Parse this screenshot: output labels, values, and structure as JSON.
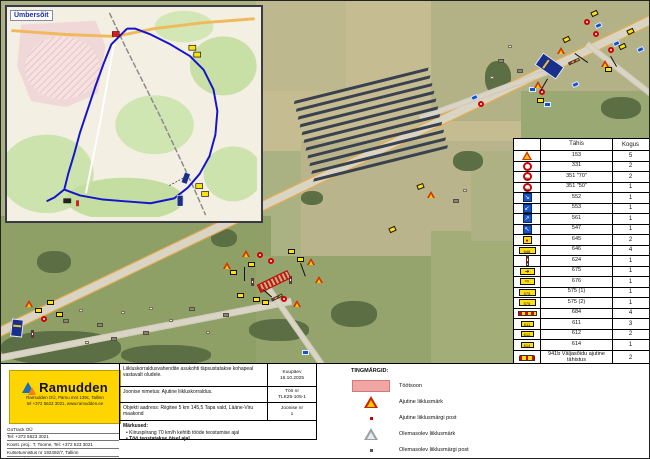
{
  "inset": {
    "label": "Ümbersõit",
    "route": "122,22 106,38 98,58 90,80 82,104 74,128 68,150 62,170 58,186 74,192 96,196 120,198 146,200 170,195 184,184 196,170 206,152 212,130 214,106 210,84 200,64 186,50 166,38 146,28 130,22 122,22",
    "route_spur": "58,186 48,194 40,198",
    "railway": "104,6 120,40 138,76 156,112 172,146 188,180 202,212",
    "main_road": "4,24 60,28 110,30 150,22 200,16 252,12",
    "side_road": "110,30 104,64 96,110 88,150 80,190"
  },
  "legend_table": {
    "headers": {
      "code": "Tähis",
      "count": "Kogus"
    },
    "rows": [
      {
        "icon": "sig-roadworks",
        "code": "153",
        "count": "5"
      },
      {
        "icon": "sig-noveh",
        "code": "331",
        "count": "2"
      },
      {
        "icon": "sig-speed",
        "glyph": "70",
        "code": "351 \"70\"",
        "count": "2"
      },
      {
        "icon": "sig-speed",
        "glyph": "50",
        "code": "351 \"50\"",
        "count": "1"
      },
      {
        "icon": "sig-blue",
        "glyph": "↘",
        "code": "552",
        "count": "1"
      },
      {
        "icon": "sig-blue",
        "glyph": "↙",
        "code": "553",
        "count": "1"
      },
      {
        "icon": "sig-blue",
        "glyph": "↗",
        "code": "561",
        "count": "1"
      },
      {
        "icon": "sig-blue",
        "glyph": "↖",
        "code": "547",
        "count": "1"
      },
      {
        "icon": "sig-ysmall",
        "glyph": "●",
        "code": "645",
        "count": "2"
      },
      {
        "icon": "sig-ywide",
        "glyph": "646",
        "code": "646",
        "count": "4"
      },
      {
        "icon": "sig-post",
        "code": "624",
        "count": "1"
      },
      {
        "icon": "sig-arrow",
        "glyph": "➔",
        "code": "675",
        "count": "1"
      },
      {
        "icon": "sig-arrow",
        "glyph": "⇨",
        "code": "676",
        "count": "1"
      },
      {
        "icon": "sig-ywide",
        "glyph": "575",
        "code": "575 (1)",
        "count": "1"
      },
      {
        "icon": "sig-ywide",
        "glyph": "575",
        "code": "575 (2)",
        "count": "1"
      },
      {
        "icon": "sig-barrier",
        "code": "684",
        "count": "4"
      },
      {
        "icon": "sig-tab",
        "glyph": "611",
        "code": "611",
        "count": "3"
      },
      {
        "icon": "sig-tab",
        "glyph": "612",
        "code": "612",
        "count": "2"
      },
      {
        "icon": "sig-tab",
        "glyph": "614",
        "code": "614",
        "count": "1"
      },
      {
        "icon": "sig-941",
        "code": "941b Väljasõidu ajutine tähistus",
        "count": "2",
        "tall": true
      },
      {
        "icon": "sig-flag-red",
        "code": "Post 1,8m",
        "count": "27"
      },
      {
        "icon": "sig-flag-magenta",
        "code": "Post 2,2m",
        "count": "3"
      },
      {
        "icon": "sig-flag-blue",
        "code": "Post 2,6m",
        "count": "2"
      },
      {
        "icon": "sig-lamp",
        "code": "Punane lamp",
        "count": "5"
      }
    ]
  },
  "tingmargid": {
    "title": "TINGMÄRGID:",
    "items": [
      {
        "icon": "tm-swatch",
        "name": "work-zone-swatch",
        "label": "Töötsoon"
      },
      {
        "icon": "tm-tri-temp",
        "name": "temporary-sign-icon",
        "label": "Ajutine liiklusmärk"
      },
      {
        "icon": "tm-dot-red",
        "name": "temporary-post-icon",
        "label": "Ajutine liiklusmärgi post"
      },
      {
        "icon": "tm-tri-ex",
        "name": "existing-sign-icon",
        "label": "Olemasolev liiklusmärk"
      },
      {
        "icon": "tm-dot-gray",
        "name": "existing-post-icon",
        "label": "Olemasolev liiklusmärgi post"
      }
    ]
  },
  "title_block": {
    "row1": {
      "text": "Liikluskorraldusvahendite asukohti täpsustatakse kohapeal vastavalt oludele.",
      "label": "Kuupäev",
      "value": "16.10.2025"
    },
    "row2": {
      "text": "Joonise nimetus: Ajutine liikluskorraldus.",
      "label": "Töö nr",
      "value": "TLK25-105-1"
    },
    "row3": {
      "text": "Objekti aadress: Riigitee 5 km 145,5 Tapa vald, Lääne-Viru maakond",
      "label": "Joonise nr",
      "value": "1"
    },
    "notes": {
      "title": "Märkused:",
      "items": [
        {
          "text": "Kiiruspiirang 70 km/h kehtib tööde teostamise ajal",
          "bold": false
        },
        {
          "text": "Töö teostatakse öisel ajal",
          "bold": true
        }
      ]
    }
  },
  "ramudden": {
    "name": "Ramudden",
    "sub": [
      "Ramudden OÜ, Pärnu mnt 139c, Tallinn",
      "tel +372 5623 3021, www.ramudden.ee"
    ]
  },
  "contact": {
    "lines": [
      "GoTrack OÜ",
      "Tel: +372 5623 3021",
      "Koost. proj.: T. Toome, Tel: +372 523 3021",
      "Kutsetunnistus nr 192492/7, Tallinn",
      "Tegevusluba nr ELK00025"
    ]
  },
  "map": {
    "markers": [
      {
        "x": 594,
        "y": 22,
        "t": "bs",
        "r": -25
      },
      {
        "x": 612,
        "y": 40,
        "t": "bs",
        "r": -25
      },
      {
        "x": 636,
        "y": 46,
        "t": "bs",
        "r": -25
      },
      {
        "x": 571,
        "y": 81,
        "t": "bs",
        "r": -25
      },
      {
        "x": 528,
        "y": 86,
        "t": "bs"
      },
      {
        "x": 543,
        "y": 101,
        "t": "bs"
      },
      {
        "x": 562,
        "y": 36,
        "t": "ys",
        "r": -25
      },
      {
        "x": 590,
        "y": 10,
        "t": "ys",
        "r": -25
      },
      {
        "x": 618,
        "y": 43,
        "t": "ys",
        "r": -25
      },
      {
        "x": 604,
        "y": 66,
        "t": "ys"
      },
      {
        "x": 536,
        "y": 97,
        "t": "ys"
      },
      {
        "x": 626,
        "y": 28,
        "t": "ys",
        "r": -25
      },
      {
        "x": 592,
        "y": 30,
        "t": "rc"
      },
      {
        "x": 607,
        "y": 46,
        "t": "rc"
      },
      {
        "x": 538,
        "y": 88,
        "t": "rc"
      },
      {
        "x": 583,
        "y": 18,
        "t": "rc"
      },
      {
        "x": 556,
        "y": 46,
        "t": "tr"
      },
      {
        "x": 600,
        "y": 59,
        "t": "tr"
      },
      {
        "x": 533,
        "y": 80,
        "t": "tr"
      },
      {
        "x": 567,
        "y": 59,
        "t": "br",
        "r": -25
      },
      {
        "x": 552,
        "y": 69,
        "t": "pp"
      },
      {
        "x": 541,
        "y": 52,
        "t": "board",
        "r": -55,
        "w": 15,
        "h": 26
      },
      {
        "x": 574,
        "y": 52,
        "t": "ln",
        "r": 35,
        "w": 16
      },
      {
        "x": 547,
        "y": 78,
        "t": "ln",
        "r": 120,
        "w": 14
      },
      {
        "x": 610,
        "y": 55,
        "t": "ln",
        "r": 60,
        "w": 12
      },
      {
        "x": 236,
        "y": 292,
        "t": "ys"
      },
      {
        "x": 247,
        "y": 261,
        "t": "ys"
      },
      {
        "x": 252,
        "y": 296,
        "t": "ys"
      },
      {
        "x": 287,
        "y": 248,
        "t": "ys"
      },
      {
        "x": 296,
        "y": 256,
        "t": "ys"
      },
      {
        "x": 261,
        "y": 299,
        "t": "ys"
      },
      {
        "x": 229,
        "y": 269,
        "t": "ys"
      },
      {
        "x": 222,
        "y": 261,
        "t": "tr"
      },
      {
        "x": 241,
        "y": 249,
        "t": "tr"
      },
      {
        "x": 306,
        "y": 257,
        "t": "tr"
      },
      {
        "x": 314,
        "y": 275,
        "t": "tr"
      },
      {
        "x": 292,
        "y": 299,
        "t": "tr"
      },
      {
        "x": 256,
        "y": 251,
        "t": "rc"
      },
      {
        "x": 280,
        "y": 295,
        "t": "rc"
      },
      {
        "x": 267,
        "y": 257,
        "t": "rc"
      },
      {
        "x": 250,
        "y": 277,
        "t": "pp"
      },
      {
        "x": 288,
        "y": 275,
        "t": "pp"
      },
      {
        "x": 270,
        "y": 295,
        "t": "br",
        "r": -26
      },
      {
        "x": 256,
        "y": 276,
        "t": "hatch",
        "r": -26,
        "w": 34,
        "h": 9
      },
      {
        "x": 244,
        "y": 266,
        "t": "ln",
        "r": 90,
        "w": 14
      },
      {
        "x": 300,
        "y": 262,
        "t": "ln",
        "r": 70,
        "w": 14
      },
      {
        "x": 262,
        "y": 288,
        "t": "ln",
        "r": 40,
        "w": 12
      },
      {
        "x": 34,
        "y": 307,
        "t": "ys"
      },
      {
        "x": 46,
        "y": 299,
        "t": "ys"
      },
      {
        "x": 55,
        "y": 311,
        "t": "ys"
      },
      {
        "x": 24,
        "y": 299,
        "t": "tr"
      },
      {
        "x": 40,
        "y": 315,
        "t": "rc"
      },
      {
        "x": 30,
        "y": 329,
        "t": "pp"
      },
      {
        "x": 10,
        "y": 318,
        "t": "board",
        "r": 6,
        "w": 12,
        "h": 18
      },
      {
        "x": 416,
        "y": 183,
        "t": "ys",
        "r": -20
      },
      {
        "x": 426,
        "y": 190,
        "t": "tr"
      },
      {
        "x": 470,
        "y": 94,
        "t": "bs",
        "r": -25
      },
      {
        "x": 477,
        "y": 100,
        "t": "rc"
      },
      {
        "x": 301,
        "y": 349,
        "t": "bs"
      },
      {
        "x": 388,
        "y": 226,
        "t": "ys",
        "r": -24
      },
      {
        "x": 62,
        "y": 318,
        "t": "bd"
      },
      {
        "x": 78,
        "y": 308,
        "t": "bw"
      },
      {
        "x": 96,
        "y": 322,
        "t": "bd"
      },
      {
        "x": 120,
        "y": 310,
        "t": "bw"
      },
      {
        "x": 142,
        "y": 330,
        "t": "bd"
      },
      {
        "x": 168,
        "y": 318,
        "t": "bw"
      },
      {
        "x": 188,
        "y": 306,
        "t": "bd"
      },
      {
        "x": 205,
        "y": 330,
        "t": "bw"
      },
      {
        "x": 222,
        "y": 312,
        "t": "bd"
      },
      {
        "x": 148,
        "y": 306,
        "t": "bw"
      },
      {
        "x": 110,
        "y": 336,
        "t": "bd"
      },
      {
        "x": 84,
        "y": 340,
        "t": "bw"
      },
      {
        "x": 497,
        "y": 58,
        "t": "bd"
      },
      {
        "x": 507,
        "y": 44,
        "t": "bw"
      },
      {
        "x": 516,
        "y": 68,
        "t": "bd"
      },
      {
        "x": 489,
        "y": 75,
        "t": "bw"
      },
      {
        "x": 452,
        "y": 198,
        "t": "bd"
      },
      {
        "x": 462,
        "y": 188,
        "t": "bw"
      }
    ]
  }
}
